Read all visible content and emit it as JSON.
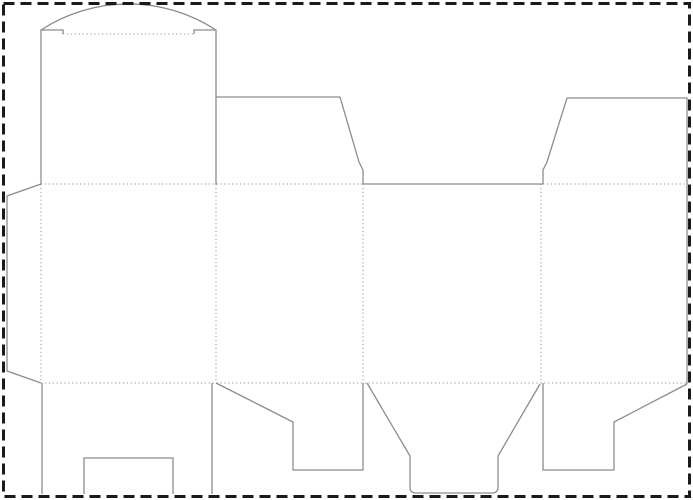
{
  "page": {
    "width": 693,
    "height": 500,
    "background_color": "#ffffff",
    "description": "Die-cut packaging template (tuck-top carton dieline) with cut lines, fold lines and artboard trim border"
  },
  "border": {
    "name": "artboard-dashed-border",
    "x": 3.5,
    "y": 3.5,
    "width": 686,
    "height": 493,
    "color": "#1a1a1a",
    "stroke_width": 3,
    "dash": "11 6"
  },
  "dieline": {
    "cut_color": "#8c8c8c",
    "cut_width": 1.3,
    "fold_color": "#9a9a9a",
    "fold_width": 1,
    "fold_dash": "1.3 2.6",
    "cut_paths": [
      {
        "id": "tuck-flap-arc",
        "d": "M 41 30 A 160 160 0 0 1 216 30"
      },
      {
        "id": "lid-left-shoulder",
        "d": "M 41 184 L 41 30 L 63 30 L 63 34"
      },
      {
        "id": "lid-right-shoulder",
        "d": "M 216 184 L 216 30 L 194 30 L 194 34"
      },
      {
        "id": "glue-flap-outline",
        "d": "M 41 184 L 7 196 L 7 371 L 41 383"
      },
      {
        "id": "dust-flap-left-top",
        "d": "M 216 97 L 340 97 L 359 162 L 363 170 L 363 184"
      },
      {
        "id": "top-edge-back-panel",
        "d": "M 363 184 L 543 184"
      },
      {
        "id": "dust-flap-right-top",
        "d": "M 543 184 L 543 170 L 547 162 L 567 98 L 687 98 L 687 384"
      },
      {
        "id": "bottom-flap-side-right",
        "d": "M 687 384 L 614 422 L 614 470 L 543 470 L 543 383"
      },
      {
        "id": "bottom-flap-back",
        "d": "M 540 384 L 498 456 L 498 487 Q 498 493 492 493 L 416 493 Q 410 493 410 487 L 410 456 L 367 383"
      },
      {
        "id": "bottom-flap-side-left",
        "d": "M 363 383 L 363 470 L 293 470 L 293 422 L 216 383"
      },
      {
        "id": "lock-flap-left-edge",
        "d": "M 42 383 L 42 494"
      },
      {
        "id": "lock-flap-right-edge",
        "d": "M 212 383 L 212 494"
      },
      {
        "id": "lock-flap-notch",
        "d": "M 84 494 L 84 458 L 173 458 L 173 494"
      }
    ],
    "fold_lines": [
      {
        "id": "tuck-crease",
        "x1": 63,
        "y1": 34,
        "x2": 194,
        "y2": 34
      },
      {
        "id": "top-fold-left",
        "x1": 41,
        "y1": 184,
        "x2": 363,
        "y2": 184
      },
      {
        "id": "top-fold-right",
        "x1": 543,
        "y1": 184,
        "x2": 687,
        "y2": 184
      },
      {
        "id": "bottom-fold",
        "x1": 41,
        "y1": 383,
        "x2": 687,
        "y2": 383
      },
      {
        "id": "glue-flap-fold",
        "x1": 41,
        "y1": 184,
        "x2": 41,
        "y2": 383
      },
      {
        "id": "panel-fold-1",
        "x1": 216,
        "y1": 184,
        "x2": 216,
        "y2": 383
      },
      {
        "id": "panel-fold-2",
        "x1": 363,
        "y1": 184,
        "x2": 363,
        "y2": 383
      },
      {
        "id": "panel-fold-3",
        "x1": 541,
        "y1": 184,
        "x2": 541,
        "y2": 383
      }
    ]
  }
}
